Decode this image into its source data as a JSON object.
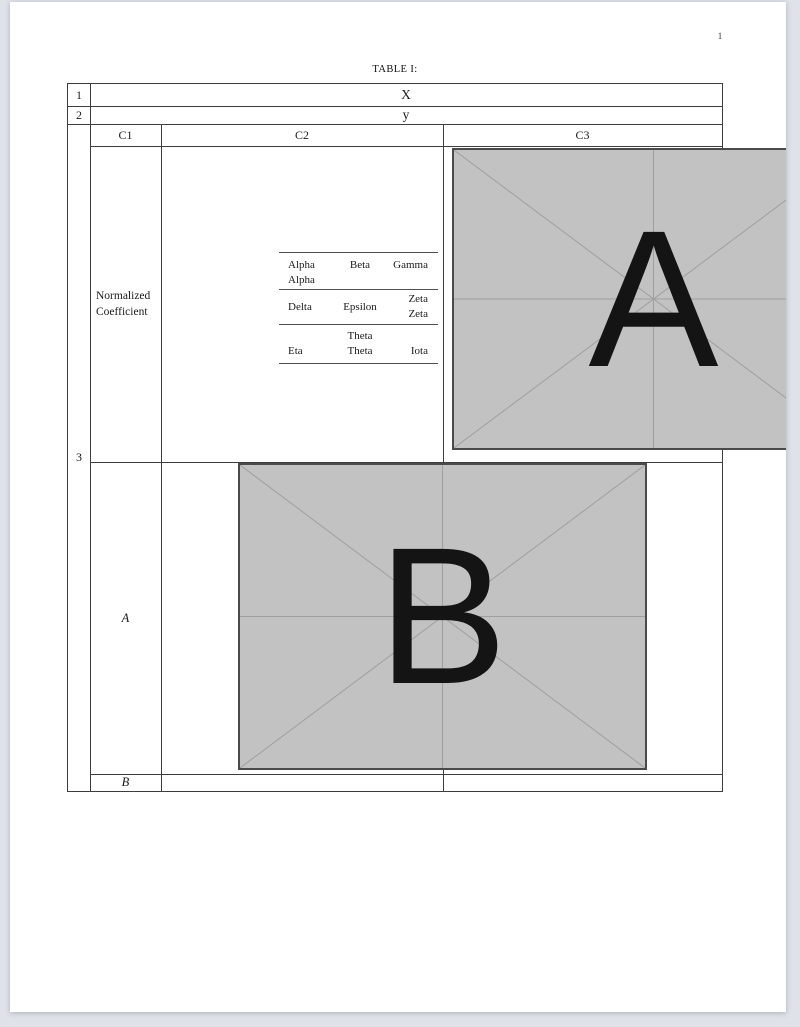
{
  "page_number": "1",
  "caption": "TABLE I:",
  "outer": {
    "row1_num": "1",
    "row1_value": "X",
    "row2_num": "2",
    "row2_value": "y",
    "row3_num": "3",
    "row_a_label": "A",
    "row_b_label": "B"
  },
  "headers": {
    "c1": "C1",
    "c2": "C2",
    "c3": "C3"
  },
  "normalized_cell": {
    "line1": "Normalized",
    "line2": "Coefficient"
  },
  "inner_table": {
    "rows": [
      {
        "c1": [
          "Alpha",
          "Alpha"
        ],
        "c2": [
          "Beta"
        ],
        "c3": [
          "Gamma"
        ]
      },
      {
        "c1": [
          "Delta"
        ],
        "c2": [
          "Epsilon"
        ],
        "c3": [
          "Zeta",
          "Zeta"
        ]
      },
      {
        "c1": [
          "Eta"
        ],
        "c2": [
          "Theta",
          "Theta"
        ],
        "c3": [
          "Iota"
        ]
      }
    ]
  },
  "placeholders": {
    "image_a": "A",
    "image_b": "B"
  },
  "colors": {
    "canvas_bg": "#dfe2e9",
    "page_bg": "#ffffff",
    "table_line": "#3d3d3d",
    "inner_line": "#4f4f4f",
    "text": "#1b1b1b",
    "placeholder_fill": "#c2c2c2",
    "placeholder_line": "#9f9f9f",
    "placeholder_border": "#4a4a4a"
  }
}
